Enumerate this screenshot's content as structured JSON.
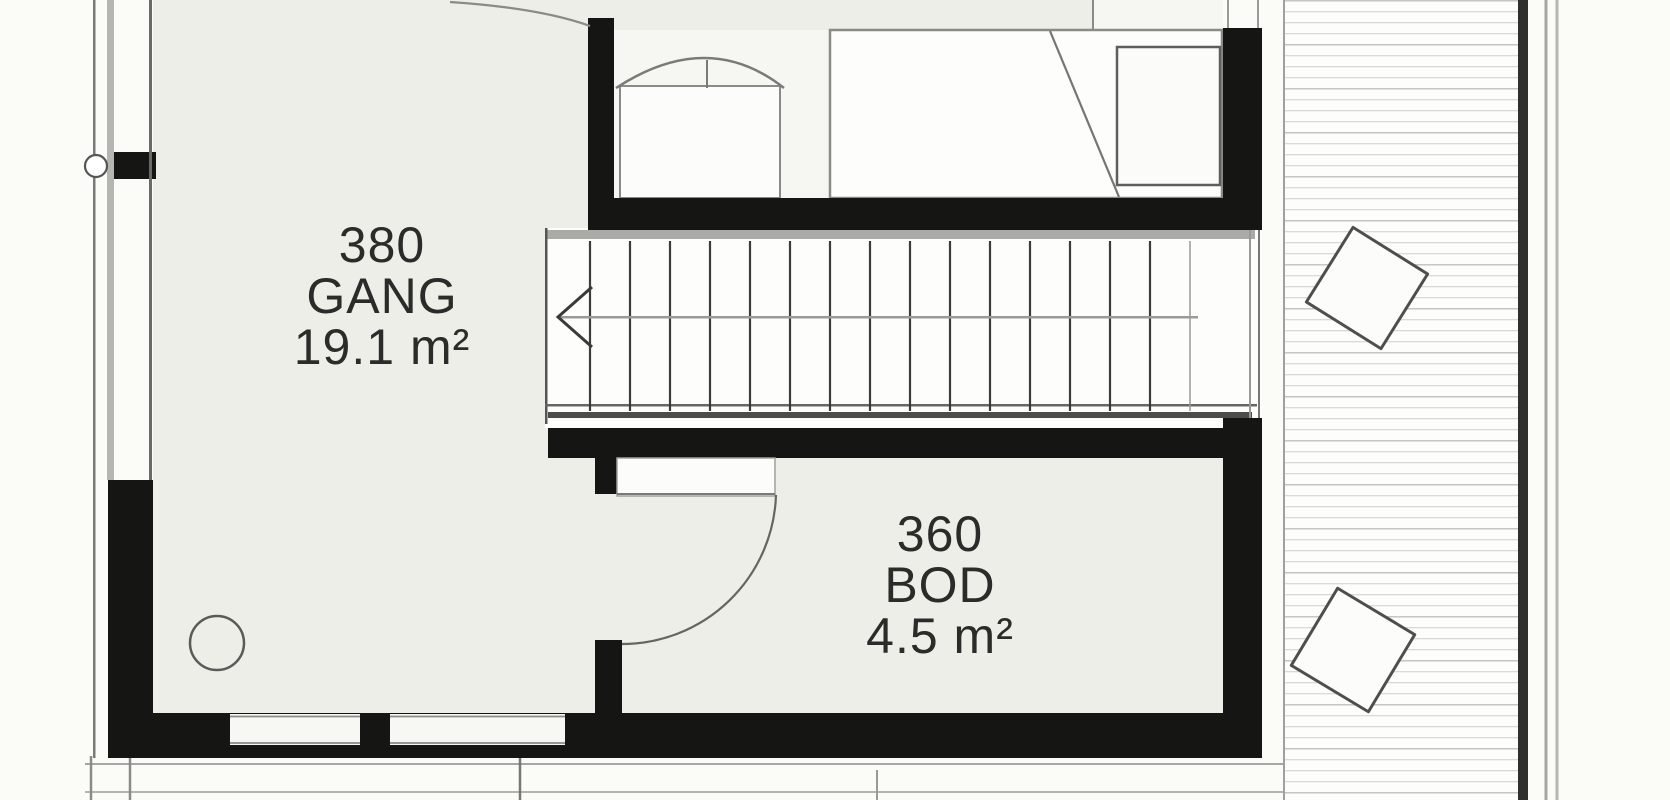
{
  "plan": {
    "rooms": {
      "gang": {
        "number": "380",
        "name": "GANG",
        "area": "19.1 m²"
      },
      "bod": {
        "number": "360",
        "name": "BOD",
        "area": "4.5 m²"
      }
    },
    "stairs": {
      "tread_count": 15,
      "direction": "left"
    },
    "colors": {
      "background": "#fbfbf8",
      "room_fill": "#eeeee9",
      "wall": "#151513",
      "line_dark": "#3e3e3c",
      "line_mid": "#8a8a86",
      "deck_board_line": "#d9d9d5",
      "deck_edge": "#2f2f2d"
    }
  }
}
